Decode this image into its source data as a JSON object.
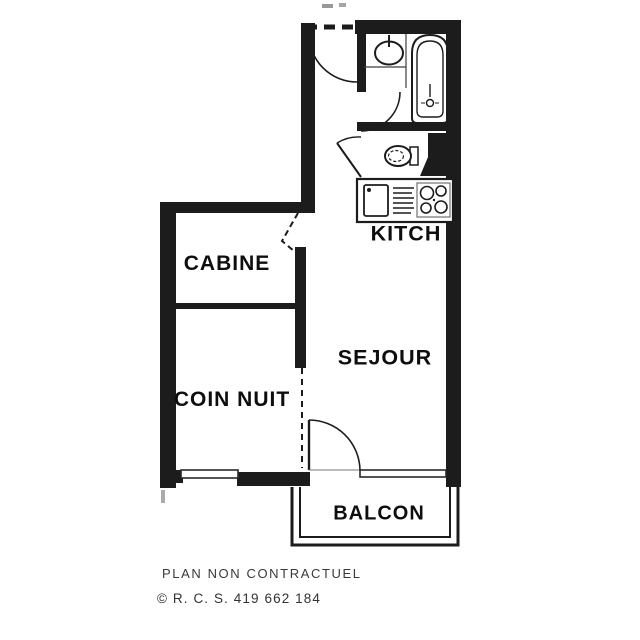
{
  "plan": {
    "title": "apartment floor plan (scanned)",
    "rooms": [
      {
        "name": "kitchen",
        "label": "KITCH"
      },
      {
        "name": "cabin",
        "label": "CABINE"
      },
      {
        "name": "living-room",
        "label": "SEJOUR"
      },
      {
        "name": "sleeping-area",
        "label": "COIN NUIT"
      },
      {
        "name": "balcony",
        "label": "BALCON"
      }
    ],
    "fixtures": [
      "entry-door",
      "washbasin",
      "bathtub",
      "toilet",
      "kitchen-sink",
      "drainboard",
      "stove-4-burners",
      "cabin-folding-door",
      "wc-door",
      "bathroom-door",
      "balcony-door",
      "window",
      "glazed-bay",
      "balcony-rail"
    ],
    "footer": {
      "line1": "PLAN NON CONTRACTUEL",
      "line2": "© R. C. S. 419 662 184"
    },
    "colors": {
      "ink": "#1c1c1c",
      "paper": "#ffffff",
      "footer_text": "#3a3a3a"
    }
  }
}
